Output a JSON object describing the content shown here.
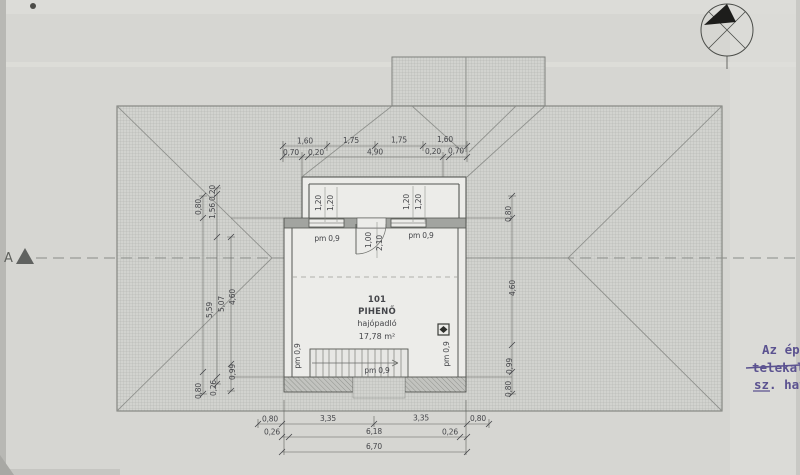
{
  "room": {
    "number": "101",
    "name": "PIHENŐ",
    "floor_label": "hajópadló",
    "area": "17,78 m²"
  },
  "labels": {
    "parapet_window_left": "pm 0,9",
    "parapet_window_right": "pm 0,9",
    "parapet_wall_left": "pm 0,9",
    "parapet_wall_right": "pm 0,9",
    "parapet_stairs": "pm 0,9",
    "door_width": "1,00",
    "door_height": "2,10",
    "window_dims": [
      "1,20",
      "1,20",
      "1,20",
      "1,20"
    ],
    "section_marker": "A"
  },
  "dimensions": {
    "top_row1": [
      "1,60",
      "1,75",
      "1,75",
      "1,60"
    ],
    "top_row2": [
      "0,70",
      "0,20",
      "4,90",
      "0,20",
      "0,70"
    ],
    "bottom_row1": [
      "0,80",
      "3,35",
      "3,35",
      "0,80"
    ],
    "bottom_row2": [
      "0,26",
      "6,18",
      "0,26"
    ],
    "bottom_total": "6,70",
    "left_col": [
      "0,80",
      "0,20",
      "1,56",
      "5,59",
      "5,07",
      "4,60",
      "0,99",
      "0,26",
      "0,80"
    ],
    "right_col": [
      "0,80",
      "4,60",
      "0,99",
      "0,80"
    ]
  },
  "notes": {
    "line1": "Az ép",
    "line2": "telekal",
    "line3": "sz. hat"
  },
  "colors": {
    "paper": "#d6d6d2",
    "ink": "#45464a",
    "note_ink": "#5b5290"
  }
}
